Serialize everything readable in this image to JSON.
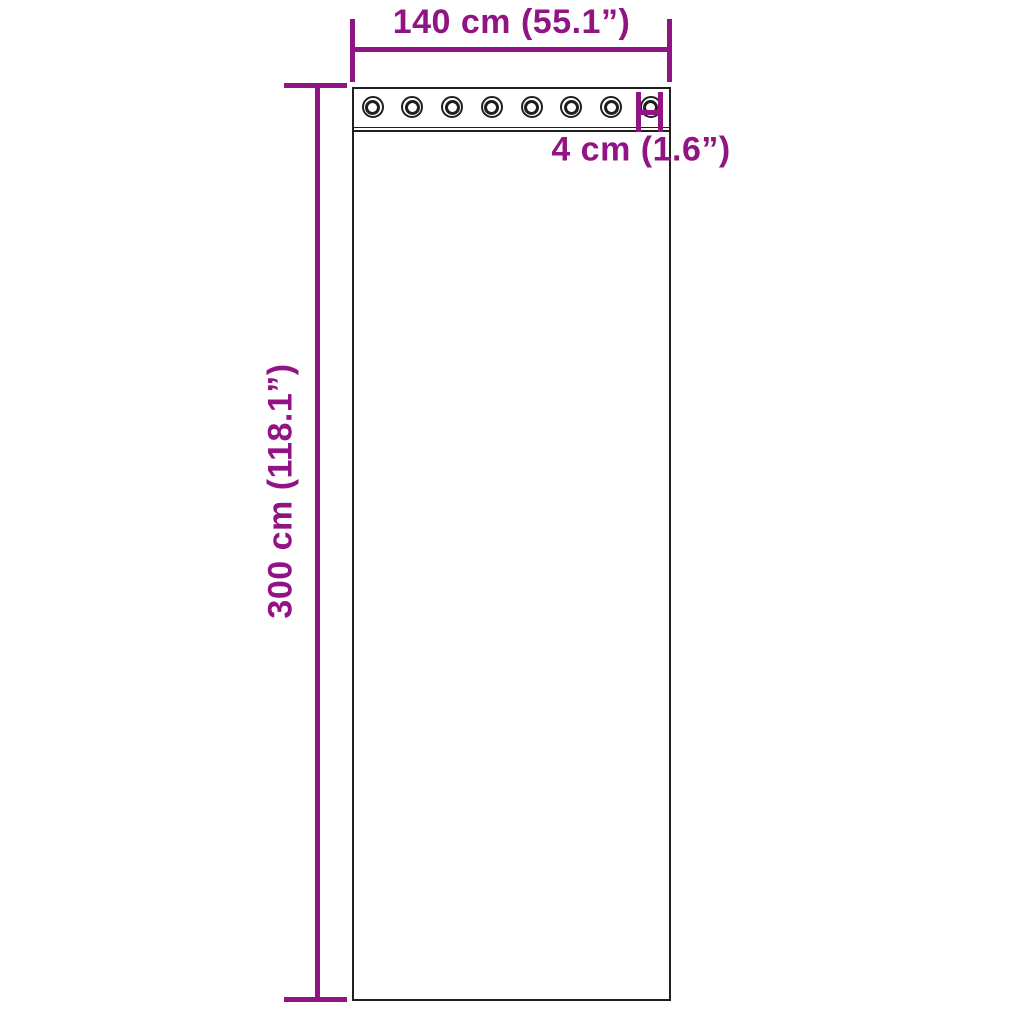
{
  "colors": {
    "dimension": "#921484",
    "outline": "#1f1f1f",
    "background": "#ffffff"
  },
  "dimensions": {
    "width": {
      "label": "140 cm (55.1”)"
    },
    "height": {
      "label": "300 cm (118.1”)"
    },
    "grommet": {
      "label": "4 cm (1.6”)"
    }
  },
  "grommets": {
    "count": 8
  }
}
